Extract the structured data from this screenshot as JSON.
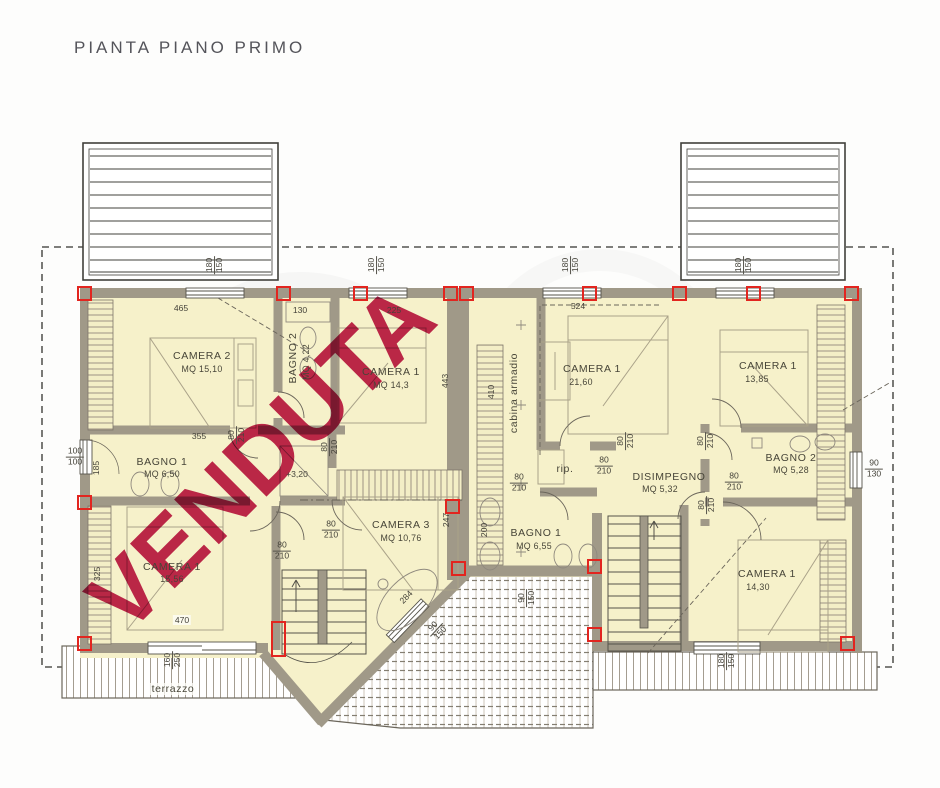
{
  "title": "PIANTA PIANO PRIMO",
  "stamp": "VENDUTA",
  "colors": {
    "stamp": "#bc164a",
    "accent_red": "#e2251f",
    "wall": "#a19a89",
    "room_fill": "#f6f1ca"
  },
  "rooms": [
    {
      "name": "CAMERA 2",
      "area": "MQ 15,10"
    },
    {
      "name": "BAGNO 2",
      "area": "MQ 4,22"
    },
    {
      "name": "CAMERA 1",
      "area": "MQ 14,3"
    },
    {
      "name": "BAGNO 1",
      "area": "MQ 6,50"
    },
    {
      "name": "CAMERA 1",
      "area": "15,56"
    },
    {
      "name": "CAMERA 3",
      "area": "MQ 10,76"
    },
    {
      "name": "cabina armadio",
      "area": ""
    },
    {
      "name": "CAMERA 1",
      "area": "21,60"
    },
    {
      "name": "rip.",
      "area": ""
    },
    {
      "name": "DISIMPEGNO",
      "area": "MQ 5,32"
    },
    {
      "name": "CAMERA 1",
      "area": "13,85"
    },
    {
      "name": "BAGNO 2",
      "area": "MQ 5,28"
    },
    {
      "name": "BAGNO 1",
      "area": "MQ 6,55"
    },
    {
      "name": "CAMERA 1",
      "area": "14,30"
    },
    {
      "name": "terrazzo",
      "area": ""
    }
  ],
  "dims": {
    "d465": "465",
    "d130": "130",
    "d225": "225",
    "d524": "524",
    "d443": "443",
    "d355": "355",
    "d185": "185",
    "d247": "247",
    "d200": "200",
    "d410": "410",
    "d470": "470",
    "d325": "325",
    "d284": "284",
    "d80": "80",
    "d210": "210",
    "d100": "100",
    "d90": "90",
    "d130w": "130",
    "d150": "150",
    "d180": "180",
    "d160": "160",
    "d250": "250",
    "quota": "+3,20"
  }
}
